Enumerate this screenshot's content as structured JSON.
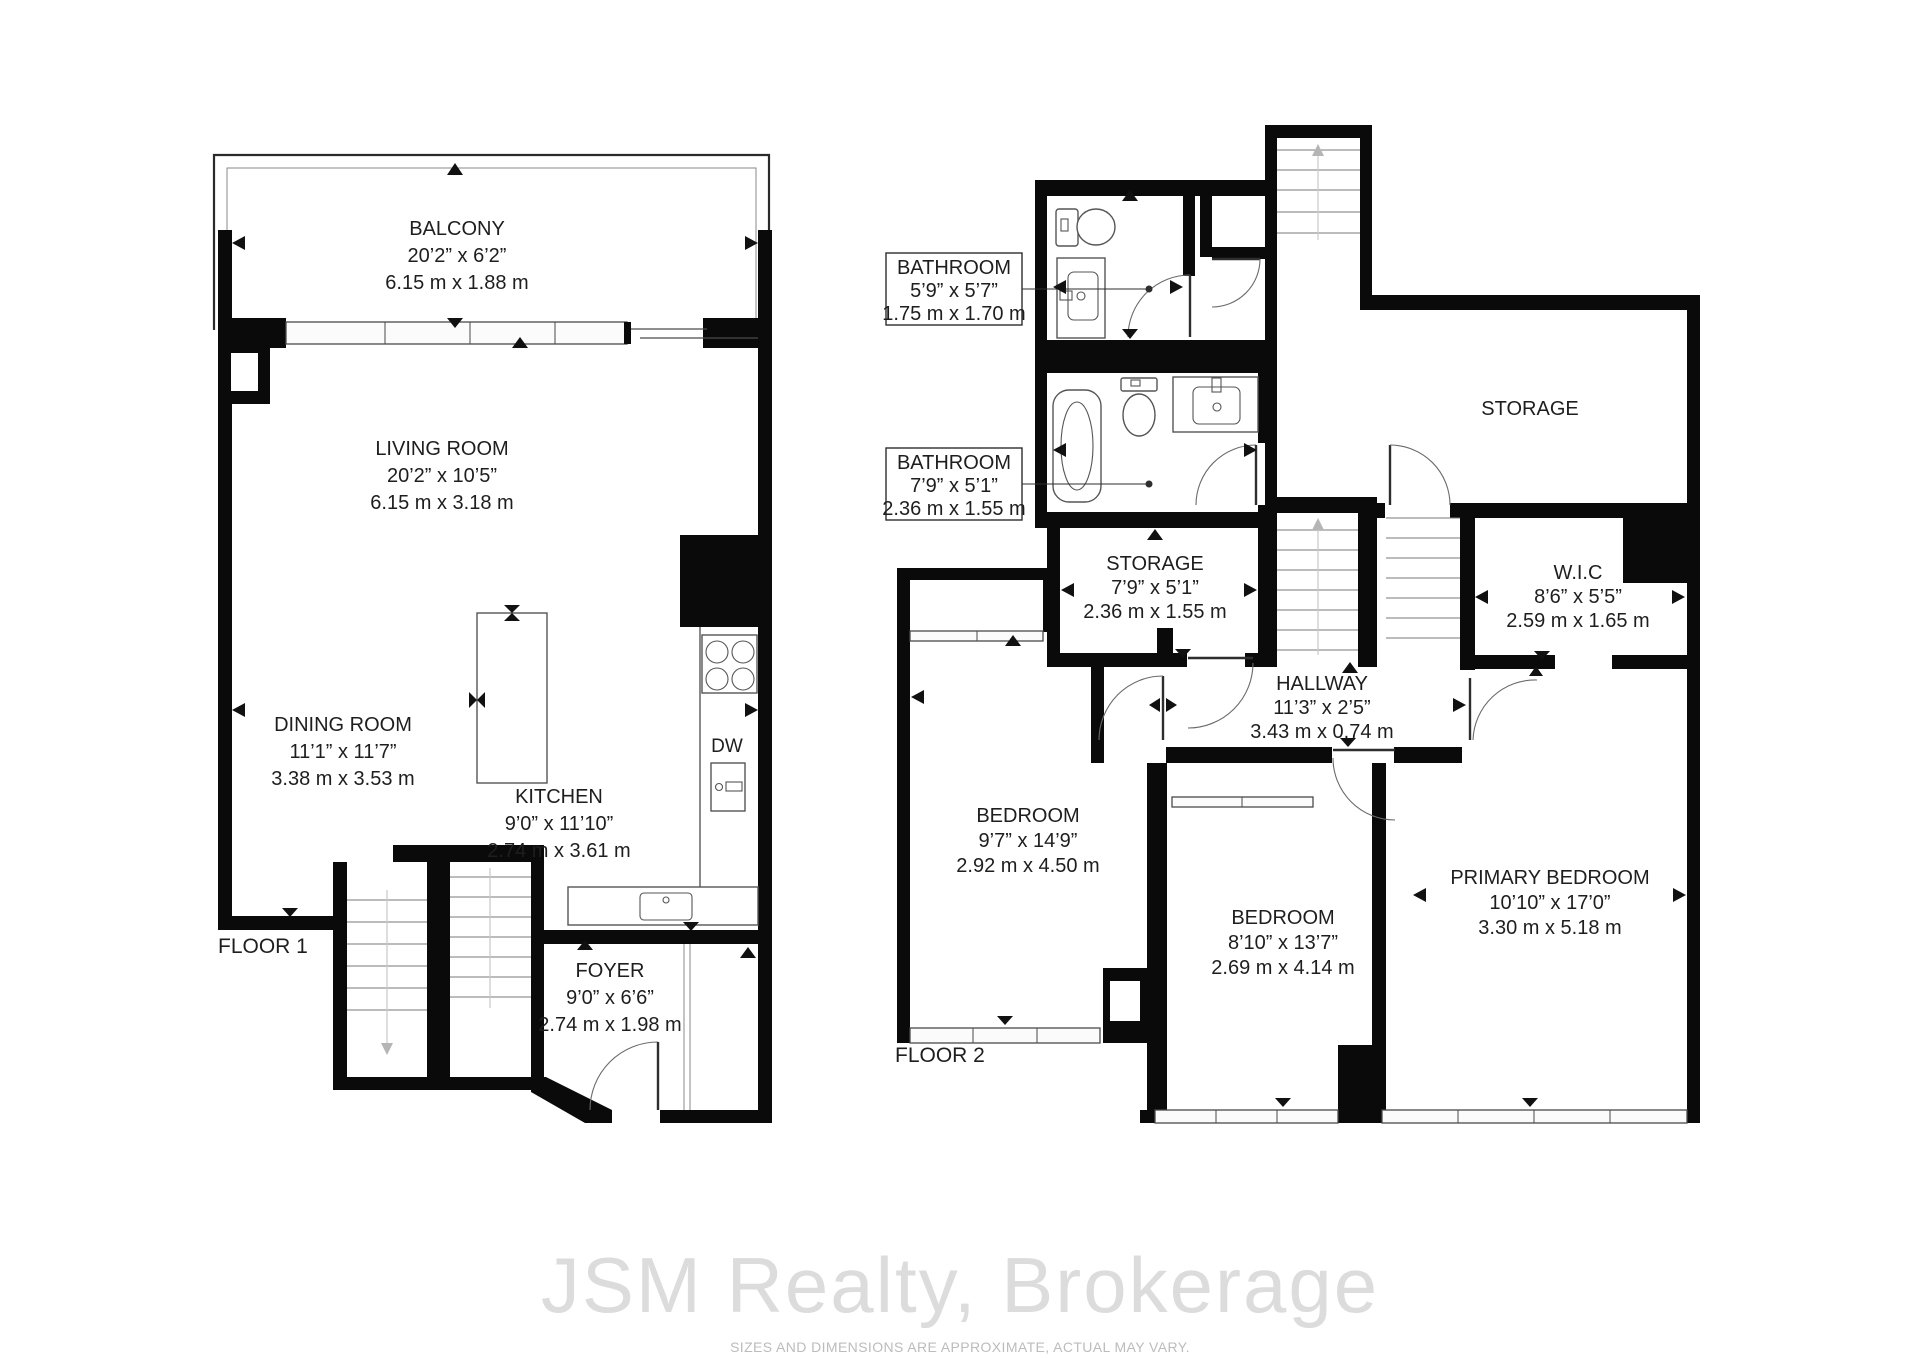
{
  "floor1": {
    "label": "FLOOR 1",
    "rooms": {
      "balcony": {
        "name": "BALCONY",
        "imperial": "20’2” x 6’2”",
        "metric": "6.15 m x 1.88 m"
      },
      "living": {
        "name": "LIVING ROOM",
        "imperial": "20’2” x 10’5”",
        "metric": "6.15 m x 3.18 m"
      },
      "dining": {
        "name": "DINING ROOM",
        "imperial": "11’1” x 11’7”",
        "metric": "3.38 m x 3.53 m"
      },
      "kitchen": {
        "name": "KITCHEN",
        "imperial": "9’0” x 11’10”",
        "metric": "2.74 m x 3.61 m"
      },
      "foyer": {
        "name": "FOYER",
        "imperial": "9’0” x 6’6”",
        "metric": "2.74 m x 1.98 m"
      }
    },
    "appliances": {
      "dishwasher": "DW"
    }
  },
  "floor2": {
    "label": "FLOOR 2",
    "rooms": {
      "bathroom_upper": {
        "name": "BATHROOM",
        "imperial": "5’9” x 5’7”",
        "metric": "1.75 m x 1.70 m"
      },
      "bathroom_lower": {
        "name": "BATHROOM",
        "imperial": "7’9” x 5’1”",
        "metric": "2.36 m x 1.55 m"
      },
      "storage_large": {
        "name": "STORAGE"
      },
      "storage_small": {
        "name": "STORAGE",
        "imperial": "7’9” x 5’1”",
        "metric": "2.36 m x 1.55 m"
      },
      "hallway": {
        "name": "HALLWAY",
        "imperial": "11’3” x 2’5”",
        "metric": "3.43 m x 0.74 m"
      },
      "wic": {
        "name": "W.I.C",
        "imperial": "8’6” x 5’5”",
        "metric": "2.59 m x 1.65 m"
      },
      "bedroom_left": {
        "name": "BEDROOM",
        "imperial": "9’7” x 14’9”",
        "metric": "2.92 m x 4.50 m"
      },
      "bedroom_middle": {
        "name": "BEDROOM",
        "imperial": "8’10” x 13’7”",
        "metric": "2.69 m x 4.14 m"
      },
      "primary": {
        "name": "PRIMARY BEDROOM",
        "imperial": "10’10” x 17’0”",
        "metric": "3.30 m x 5.18 m"
      }
    }
  },
  "footer": {
    "watermark": "JSM Realty, Brokerage",
    "disclaimer": "SIZES AND DIMENSIONS ARE APPROXIMATE, ACTUAL MAY VARY."
  },
  "colors": {
    "wall": "#0a0a0a",
    "text": "#1e1e1e",
    "watermark": "#dcdcdc"
  }
}
